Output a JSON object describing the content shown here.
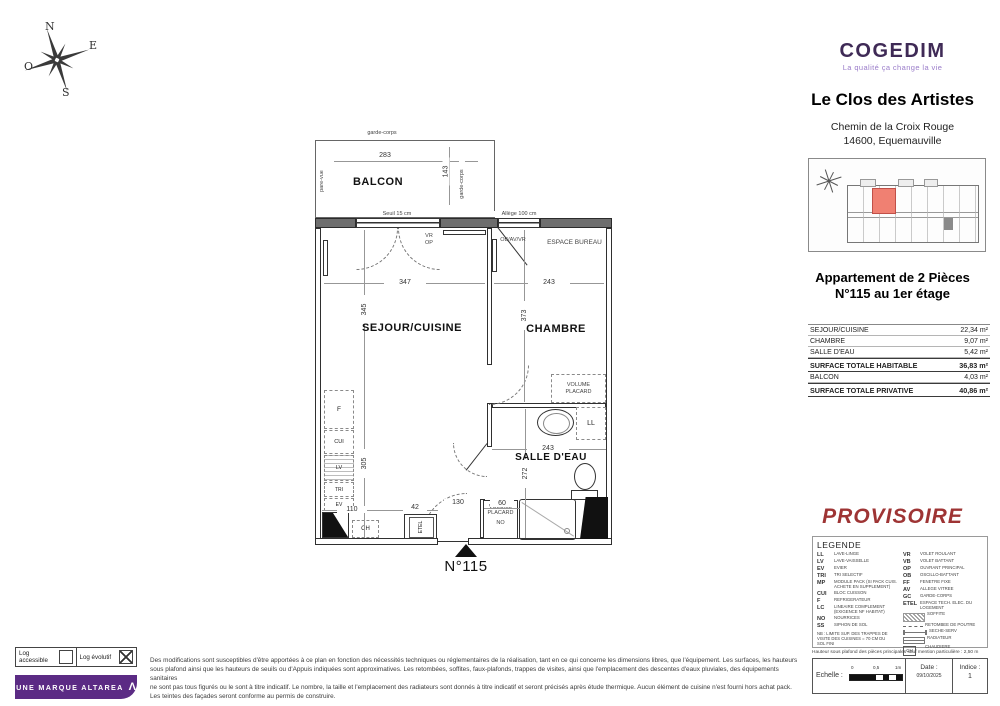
{
  "compass": {
    "n": "N",
    "e": "E",
    "s": "S",
    "o": "O"
  },
  "header": {
    "brand": "COGEDIM",
    "tagline": "La qualité ça change la vie",
    "project": "Le Clos des Artistes",
    "address_line1": "Chemin de la Croix Rouge",
    "address_line2": "14600, Equemauville"
  },
  "apartment": {
    "line1": "Appartement de 2 Pièces",
    "line2": "N°115 au 1er étage"
  },
  "areas": {
    "rows": [
      {
        "label": "SEJOUR/CUISINE",
        "value": "22,34",
        "unit": "m²"
      },
      {
        "label": "CHAMBRE",
        "value": "9,07",
        "unit": "m²"
      },
      {
        "label": "SALLE D'EAU",
        "value": "5,42",
        "unit": "m²"
      },
      {
        "label": "SURFACE TOTALE HABITABLE",
        "value": "36,83",
        "unit": "m²"
      },
      {
        "label": "BALCON",
        "value": "4,03",
        "unit": "m²"
      },
      {
        "label": "SURFACE TOTALE PRIVATIVE",
        "value": "40,86",
        "unit": "m²"
      }
    ]
  },
  "plan": {
    "rooms": {
      "balcon": "BALCON",
      "sejour": "SEJOUR/CUISINE",
      "chambre": "CHAMBRE",
      "salle_eau": "SALLE D'EAU",
      "espace_bureau": "ESPACE BUREAU",
      "volume_placard_chambre": "VOLUME PLACARD",
      "volume_placard_entree": "VOLUME PLACARD",
      "no_label": "NO",
      "unit": "N°115"
    },
    "dims": {
      "balcon_w": "283",
      "balcon_d": "143",
      "sejour_w": "347",
      "sejour_h": "345",
      "chambre_w": "243",
      "chambre_h": "373",
      "cuisine_h": "305",
      "sdb_h": "272",
      "sdb_w": "243",
      "d110": "110",
      "d42": "42",
      "d130": "130",
      "d60": "60"
    },
    "labels": {
      "garde_corps_top": "garde-corps",
      "garde_corps_right": "garde-corps",
      "pare_vue": "pare-vue",
      "seuil": "Seuil 15 cm",
      "allege": "Allège 100 cm",
      "vr": "VR",
      "op": "OP",
      "ob_av_vr": "OB/AV/VR",
      "ll": "LL"
    },
    "appliances": {
      "f": "F",
      "cui": "CUI",
      "lv": "LV",
      "tri": "TRI",
      "ev": "EV",
      "ch": "CH",
      "etel": "ETEL"
    }
  },
  "provisoire": "PROVISOIRE",
  "legend": {
    "title": "LEGENDE",
    "left": [
      {
        "abbr": "LL",
        "label": "LAVE-LINGE"
      },
      {
        "abbr": "LV",
        "label": "LAVE-VAISSELLE"
      },
      {
        "abbr": "EV",
        "label": "EVIER"
      },
      {
        "abbr": "TRI",
        "label": "TRI SELECTIF"
      },
      {
        "abbr": "MP",
        "label": "MODULE PACK (SI PACK CUIS. ACHETE EN SUPPLEMENT)"
      },
      {
        "abbr": "CUI",
        "label": "BLOC CUISSON"
      },
      {
        "abbr": "F",
        "label": "REFRIGERATEUR"
      },
      {
        "abbr": "LC",
        "label": "LINEAIRE COMPLEMENT (EXIGENCE NF HABITAT)"
      },
      {
        "abbr": "NO",
        "label": "NOURRICES"
      },
      {
        "abbr": "SS",
        "label": "SIPHON DE SOL"
      }
    ],
    "right": [
      {
        "abbr": "VR",
        "label": "VOLET ROULANT"
      },
      {
        "abbr": "VB",
        "label": "VOLET BATTANT"
      },
      {
        "abbr": "OP",
        "label": "OUVRANT PRINCIPAL"
      },
      {
        "abbr": "OB",
        "label": "OSCILLO-BATTANT"
      },
      {
        "abbr": "FF",
        "label": "FENETRE FIXE"
      },
      {
        "abbr": "AV",
        "label": "ALLEGE VITREE"
      },
      {
        "abbr": "GC",
        "label": "GARDE-CORPS"
      },
      {
        "abbr": "ETEL",
        "label": "ESPACE TECH. ELEC. DU LOGEMENT"
      }
    ],
    "symbols": [
      {
        "label": "SOFFITE"
      },
      {
        "label": "RETOMBEE DE POUTRE"
      },
      {
        "label": "SECHE-SERV"
      },
      {
        "label": "RADIATEUR"
      },
      {
        "abbr": "CH",
        "label": "CHAUDIERE"
      }
    ],
    "nb": "NB : LIMITE SUP. DES TRAPPES DE VISITE DES CUISINES = 70 CM DU SOL FINI"
  },
  "footer_right": {
    "ceiling_note": "Hauteur sous plafond des pièces principales sauf mention particulière : 2,50 m",
    "scale_label": "Echelle :",
    "tick0": "0",
    "tick05": "0,5",
    "tick1": "1m",
    "date_label": "Date :",
    "date_value": "09/10/2025",
    "indice_label": "Indice :",
    "indice_value": "1"
  },
  "footer_left": {
    "accessible": "Log accessible",
    "evolutif": "Log évolutif",
    "banner": "UNE MARQUE ALTAREA",
    "banner_symbol": "Λ"
  },
  "disclaimer": {
    "l1": "Des modifications sont susceptibles d'être apportées à ce plan en fonction des nécessités techniques ou réglementaires de la réalisation, tant en ce qui concerne les dimensions libres, que l'équipement. Les surfaces, les hauteurs",
    "l2": "sous plafond ainsi que les hauteurs de seuils ou d'Appuis indiquées sont approximatives. Les retombées, soffites, faux-plafonds, trappes de visites, ainsi que l'emplacement des descentes d'eaux pluviales, des équipements sanitaires",
    "l3": "ne sont pas tous figurés ou le sont à titre indicatif. Le nombre, la taille et l'emplacement des radiateurs sont donnés à titre indicatif et seront précisés après étude thermique. Aucun élément de cuisine n'est fourni hors achat pack.",
    "l4": "Les teintes des façades seront conforme au permis de construire."
  },
  "colors": {
    "brand_purple": "#3F2A56",
    "tagline_purple": "#9A7CC9",
    "altarea_purple": "#5B2B84",
    "provisoire_red": "#9E3434",
    "highlight_red": "#F08072"
  }
}
